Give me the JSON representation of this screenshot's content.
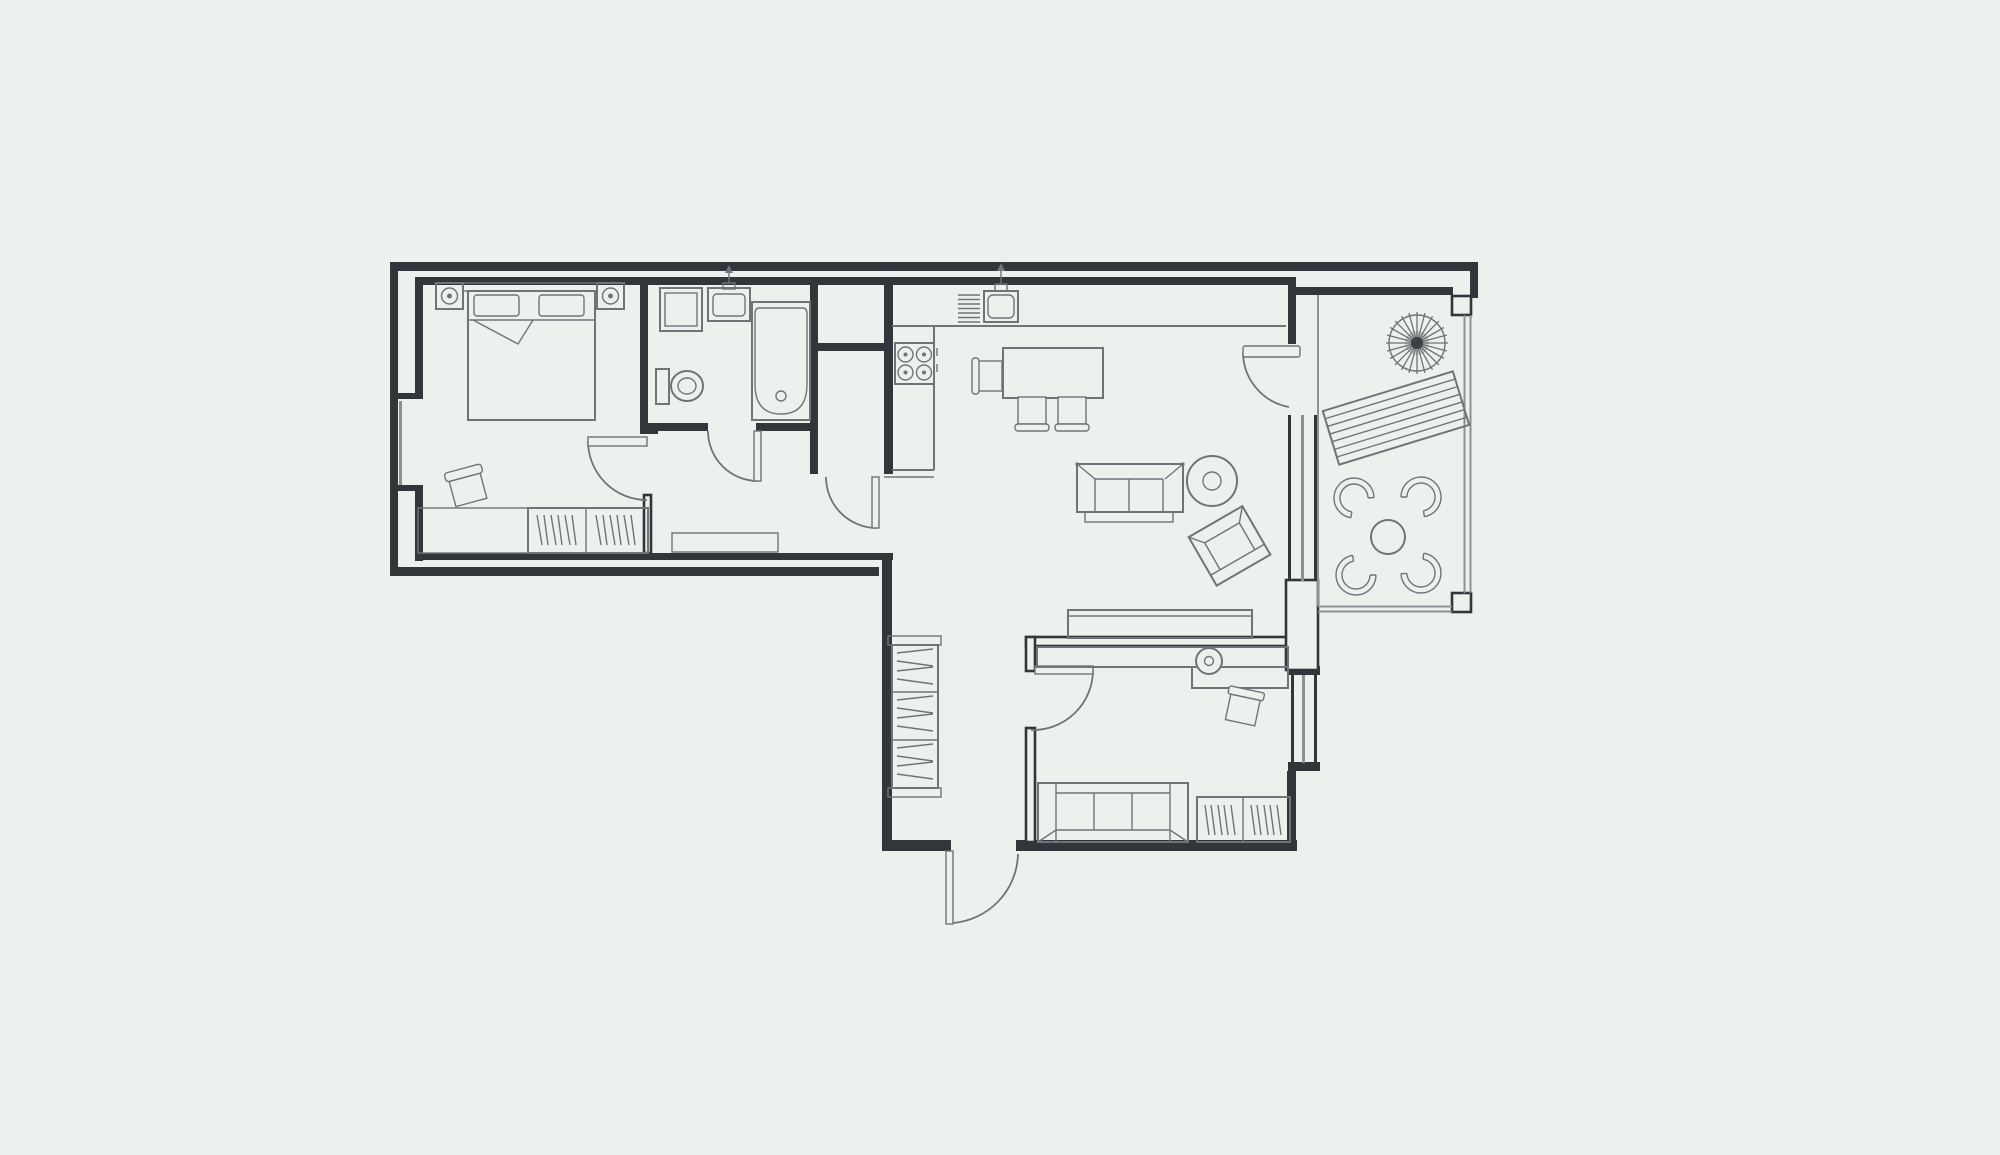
{
  "title": "apartment-floor-plan",
  "colors": {
    "background": "#edf1ee",
    "wall": "#30363a",
    "furniture": "#6e7478",
    "railing": "#8b9194",
    "parasol_center": "#3b4043"
  },
  "plan": {
    "rooms": [
      {
        "name": "bedroom",
        "furniture": [
          "double-bed",
          "two-pillows",
          "headboard",
          "nightstand-with-lamp",
          "nightstand-with-lamp",
          "side-chair",
          "low-shelf",
          "wardrobe-with-hangers"
        ]
      },
      {
        "name": "bathroom",
        "furniture": [
          "washing-machine",
          "wash-basin-with-faucet",
          "toilet",
          "bathtub-with-drain"
        ]
      },
      {
        "name": "storage-closet",
        "furniture": []
      },
      {
        "name": "hallway",
        "furniture": [
          "shoe-cabinet"
        ]
      },
      {
        "name": "kitchen",
        "furniture": [
          "l-shaped-counter",
          "sink-with-drainer-and-faucet",
          "four-burner-stove",
          "dining-table",
          "dining-chair",
          "dining-chair",
          "dining-chair"
        ]
      },
      {
        "name": "living-area",
        "furniture": [
          "two-seat-sofa",
          "round-pouf",
          "armchair",
          "sideboard"
        ]
      },
      {
        "name": "entry-corridor",
        "furniture": [
          "bookshelf-unit"
        ]
      },
      {
        "name": "study-room",
        "furniture": [
          "desk-counter",
          "desk-chair",
          "side-chair",
          "three-seat-sofa",
          "wardrobe-with-hangers"
        ]
      },
      {
        "name": "balcony",
        "furniture": [
          "parasol",
          "sun-lounger",
          "round-table",
          "shell-chair",
          "shell-chair",
          "shell-chair",
          "shell-chair"
        ]
      }
    ],
    "doors": [
      "bedroom-door",
      "bathroom-door",
      "closet-door",
      "study-door",
      "balcony-door",
      "entry-door"
    ],
    "windows": [
      "bedroom-window",
      "balcony-window",
      "study-window"
    ],
    "balcony_chair_count": 4,
    "parasol_spokes": 24
  }
}
